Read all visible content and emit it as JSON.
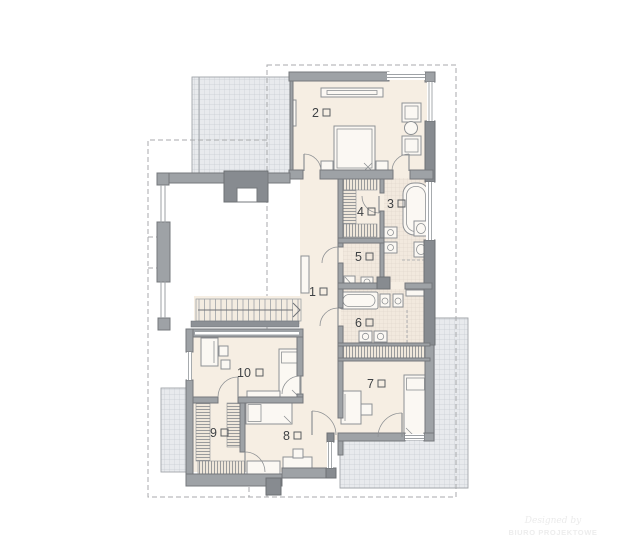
{
  "rooms": [
    {
      "number": "1"
    },
    {
      "number": "2"
    },
    {
      "number": "3"
    },
    {
      "number": "4"
    },
    {
      "number": "5"
    },
    {
      "number": "6"
    },
    {
      "number": "7"
    },
    {
      "number": "8"
    },
    {
      "number": "9"
    },
    {
      "number": "10"
    }
  ],
  "watermark": {
    "line1": "Designed by",
    "line2": "BIURO PROJEKTOWE"
  },
  "colors": {
    "wall": "#9ea2a6",
    "wallDark": "#878b90",
    "floor": "#f6eee3",
    "tile": "#f2e9de",
    "terrace": "#e8eaed",
    "terraceLine": "#c9cdd3",
    "outline": "#8e9194",
    "label": "#3f4245",
    "dash": "#a8aaac",
    "railing": "#8d9196"
  }
}
